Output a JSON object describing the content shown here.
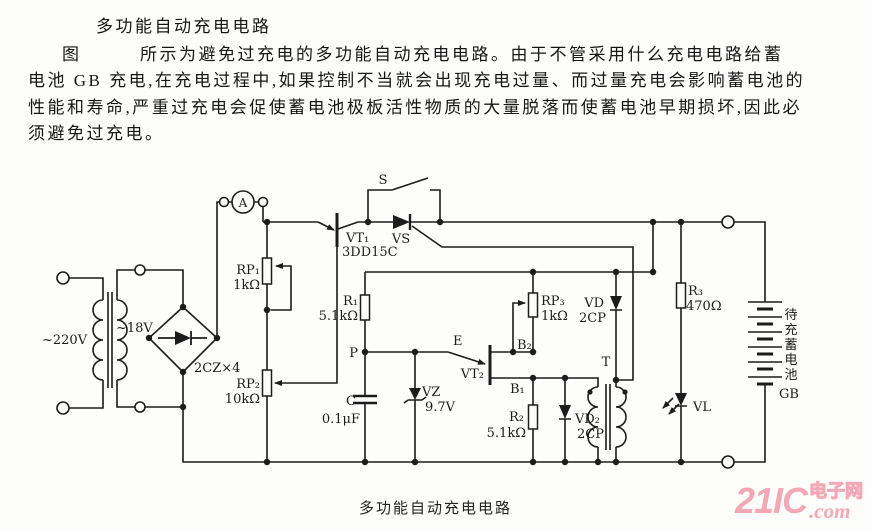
{
  "document": {
    "title": "多功能自动充电电路",
    "paragraph_lines": [
      "图　　　所示为避免过充电的多功能自动充电电路。由于不管采用什么充电电路给蓄",
      "电池 GB 充电,在充电过程中,如果控制不当就会出现充电过量、而过量充电会影响蓄电池的",
      "性能和寿命,严重过充电会促使蓄电池极板活性物质的大量脱落而使蓄电池早期损坏,因此必",
      "须避免过充电。"
    ],
    "caption": "多功能自动充电电路"
  },
  "watermark": {
    "brand": "21IC",
    "cn": "电子网",
    "com": ".com",
    "color": "#f2a9b5"
  },
  "circuit": {
    "mains": "~220V",
    "secondary": "~18V",
    "bridge": "2CZ×4",
    "meter": "A",
    "switch": "S",
    "thyristor": "VS",
    "vt1": {
      "ref": "VT₁",
      "part": "3DD15C"
    },
    "rp1": {
      "ref": "RP₁",
      "value": "1kΩ"
    },
    "rp2": {
      "ref": "RP₂",
      "value": "10kΩ"
    },
    "r1": {
      "ref": "R₁",
      "value": "5.1kΩ"
    },
    "p_node": "P",
    "cap": {
      "ref": "C",
      "value": "0.1μF"
    },
    "zener": {
      "ref": "VZ",
      "value": "9.7V"
    },
    "ujt": {
      "ref": "VT₂",
      "e": "E",
      "b2": "B₂",
      "b1": "B₁"
    },
    "rp3": {
      "ref": "RP₃",
      "value": "1kΩ"
    },
    "r2": {
      "ref": "R₂",
      "value": "5.1kΩ"
    },
    "vd": {
      "ref": "VD",
      "part": "2CP"
    },
    "vd2": {
      "ref": "VD₂",
      "part": "2CP"
    },
    "pulse_transformer": "T",
    "r3": {
      "ref": "R₃",
      "value": "470Ω"
    },
    "led": "VL",
    "battery": {
      "chars": [
        "待",
        "充",
        "蓄",
        "电",
        "池"
      ],
      "ref": "GB"
    }
  }
}
